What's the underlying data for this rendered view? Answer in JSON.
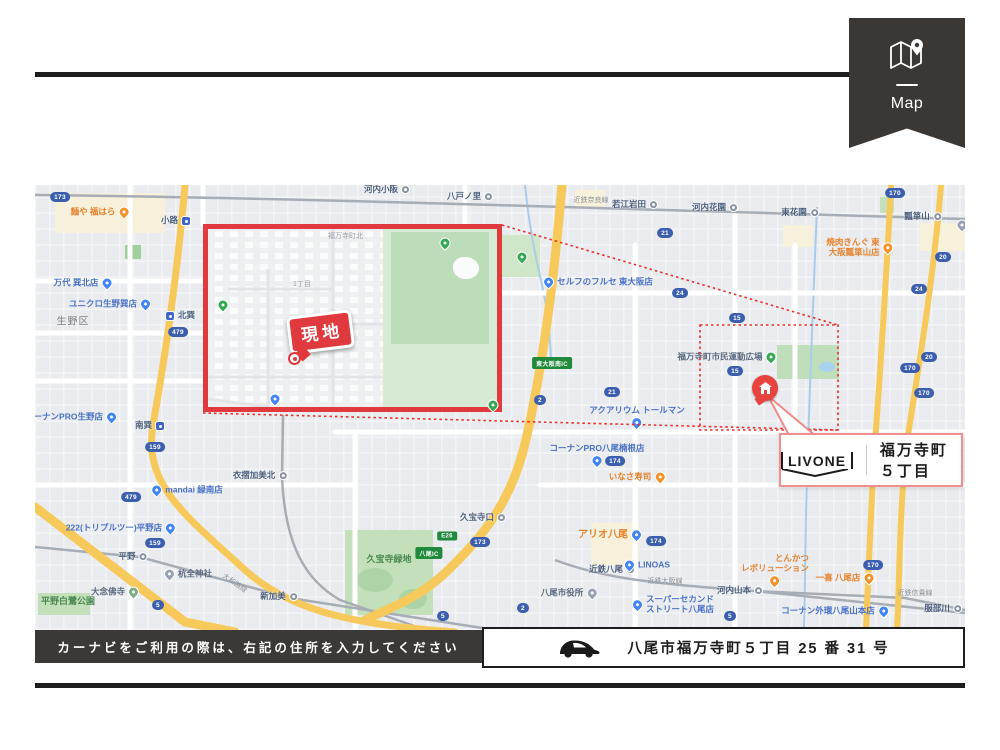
{
  "ribbon": {
    "label": "Map"
  },
  "inset": {
    "site_bubble": "現地",
    "area_label": "福万寺町北",
    "block_label": "1丁目"
  },
  "callout": {
    "brand": "LIVONE",
    "place": "福万寺町５丁目"
  },
  "footer": {
    "instruction": "カーナビをご利用の際は、右記の住所を入力してください",
    "address": "八尾市福万寺町５丁目 25 番 31 号"
  },
  "colors": {
    "accent_red": "#e0393e",
    "ribbon_bg": "#3a3734",
    "map_bg": "#e9ebee",
    "road_yellow": "#f6c95a",
    "park_green": "#c7e3c1",
    "badge_blue": "#3b5fae",
    "badge_green": "#1f8a3b",
    "shop_blue": "#4a72c8",
    "food_orange": "#e8822c"
  },
  "map": {
    "labels": [
      {
        "t": "小路",
        "x": 141,
        "y": 36,
        "k": "st-sub"
      },
      {
        "t": "北巽",
        "x": 145,
        "y": 131,
        "k": "st-sub",
        "s": "l"
      },
      {
        "t": "南巽",
        "x": 115,
        "y": 241,
        "k": "st-sub"
      },
      {
        "t": "河内小阪",
        "x": 352,
        "y": 5,
        "k": "st-rail"
      },
      {
        "t": "八戸ノ里",
        "x": 435,
        "y": 12,
        "k": "st-rail"
      },
      {
        "t": "若江岩田",
        "x": 600,
        "y": 20,
        "k": "st-rail"
      },
      {
        "t": "河内花園",
        "x": 680,
        "y": 23,
        "k": "st-rail"
      },
      {
        "t": "東花園",
        "x": 765,
        "y": 28,
        "k": "st-rail"
      },
      {
        "t": "瓢箪山",
        "x": 888,
        "y": 32,
        "k": "st-rail"
      },
      {
        "t": "久宝寺口",
        "x": 448,
        "y": 333,
        "k": "st-rail"
      },
      {
        "t": "近鉄八尾",
        "x": 577,
        "y": 385,
        "k": "st-rail"
      },
      {
        "t": "河内山本",
        "x": 705,
        "y": 406,
        "k": "st-rail"
      },
      {
        "t": "服部川",
        "x": 908,
        "y": 424,
        "k": "st-rail"
      },
      {
        "t": "平野",
        "x": 98,
        "y": 372,
        "k": "st-rail"
      },
      {
        "t": "新加美",
        "x": 244,
        "y": 412,
        "k": "st-rail"
      },
      {
        "t": "衣摺加美北",
        "x": 225,
        "y": 291,
        "k": "st-rail"
      },
      {
        "t": "万代 巽北店",
        "x": 48,
        "y": 98,
        "k": "shop"
      },
      {
        "t": "ユニクロ生野巽店",
        "x": 75,
        "y": 119,
        "k": "shop"
      },
      {
        "t": "コーナンPRO生野店",
        "x": 36,
        "y": 232,
        "k": "shop"
      },
      {
        "t": "mandai 緑南店",
        "x": 152,
        "y": 305,
        "k": "shop",
        "s": "l"
      },
      {
        "t": "222(トリプルツー)平野店",
        "x": 86,
        "y": 343,
        "k": "shop"
      },
      {
        "t": "セルフのフルセ 東大阪店",
        "x": 563,
        "y": 97,
        "k": "shop",
        "s": "l"
      },
      {
        "t": "アクアリウム トールマン",
        "x": 602,
        "y": 232,
        "k": "shop",
        "s": "b"
      },
      {
        "t": "コーナンPRO八尾楠根店",
        "x": 562,
        "y": 270,
        "k": "shop",
        "s": "b"
      },
      {
        "t": "LINOAS",
        "x": 612,
        "y": 380,
        "k": "shop",
        "s": "l"
      },
      {
        "t": "スーパーセカンド\nストリート八尾店",
        "x": 638,
        "y": 420,
        "k": "shop",
        "s": "l"
      },
      {
        "t": "コーナン外環八尾山本店",
        "x": 800,
        "y": 426,
        "k": "shop"
      },
      {
        "t": "アリオ八尾",
        "x": 575,
        "y": 350,
        "k": "mall"
      },
      {
        "t": "麺や 福はら",
        "x": 65,
        "y": 27,
        "k": "food"
      },
      {
        "t": "焼肉きんぐ 東\n大阪瓢箪山店",
        "x": 825,
        "y": 63,
        "k": "food"
      },
      {
        "t": "いなさ寿司",
        "x": 602,
        "y": 292,
        "k": "food"
      },
      {
        "t": "とんかつ\nレボリューション",
        "x": 740,
        "y": 385,
        "k": "food",
        "s": "b"
      },
      {
        "t": "一喜 八尾店",
        "x": 810,
        "y": 393,
        "k": "food"
      },
      {
        "t": "八尾市役所",
        "x": 534,
        "y": 408,
        "k": "govt"
      },
      {
        "t": "杭全神社",
        "x": 153,
        "y": 389,
        "k": "shrine",
        "s": "l"
      },
      {
        "t": "大念佛寺",
        "x": 80,
        "y": 407,
        "k": "temple"
      },
      {
        "t": "福万寺町市民運動広場",
        "x": 692,
        "y": 172,
        "k": "park-poi"
      },
      {
        "t": "生野区",
        "x": 38,
        "y": 137,
        "k": "district"
      },
      {
        "t": "久宝寺緑地",
        "x": 354,
        "y": 374,
        "k": "park"
      },
      {
        "t": "平野白鷺公園",
        "x": 33,
        "y": 416,
        "k": "park"
      },
      {
        "t": "近鉄奈良線",
        "x": 556,
        "y": 16,
        "k": "rail"
      },
      {
        "t": "近鉄大阪線",
        "x": 630,
        "y": 397,
        "k": "rail"
      },
      {
        "t": "近鉄信貴線",
        "x": 880,
        "y": 409,
        "k": "rail"
      },
      {
        "t": "大和路線",
        "x": 199,
        "y": 399,
        "k": "rail",
        "r": 35
      },
      {
        "t": "",
        "x": 487,
        "y": 72,
        "k": "pin"
      },
      {
        "t": "",
        "x": 927,
        "y": 40,
        "k": "pin-g"
      }
    ],
    "badges": [
      {
        "t": "173",
        "x": 25,
        "y": 12
      },
      {
        "t": "479",
        "x": 143,
        "y": 147
      },
      {
        "t": "479",
        "x": 96,
        "y": 312
      },
      {
        "t": "159",
        "x": 120,
        "y": 262
      },
      {
        "t": "159",
        "x": 120,
        "y": 358
      },
      {
        "t": "5",
        "x": 123,
        "y": 420
      },
      {
        "t": "2",
        "x": 505,
        "y": 215
      },
      {
        "t": "21",
        "x": 577,
        "y": 207
      },
      {
        "t": "21",
        "x": 630,
        "y": 48
      },
      {
        "t": "24",
        "x": 645,
        "y": 108
      },
      {
        "t": "24",
        "x": 884,
        "y": 104
      },
      {
        "t": "174",
        "x": 580,
        "y": 276
      },
      {
        "t": "174",
        "x": 621,
        "y": 356
      },
      {
        "t": "15",
        "x": 702,
        "y": 133
      },
      {
        "t": "15",
        "x": 700,
        "y": 186
      },
      {
        "t": "170",
        "x": 860,
        "y": 8
      },
      {
        "t": "170",
        "x": 875,
        "y": 183
      },
      {
        "t": "170",
        "x": 889,
        "y": 208
      },
      {
        "t": "170",
        "x": 838,
        "y": 380
      },
      {
        "t": "20",
        "x": 908,
        "y": 72
      },
      {
        "t": "20",
        "x": 894,
        "y": 172
      },
      {
        "t": "173",
        "x": 445,
        "y": 357
      },
      {
        "t": "2",
        "x": 488,
        "y": 423
      },
      {
        "t": "5",
        "x": 408,
        "y": 431
      },
      {
        "t": "5",
        "x": 695,
        "y": 431
      },
      {
        "t": "東大阪南IC",
        "x": 517,
        "y": 178,
        "v": "g"
      },
      {
        "t": "E26",
        "x": 412,
        "y": 351,
        "v": "g"
      },
      {
        "t": "八尾IC",
        "x": 394,
        "y": 368,
        "v": "g"
      }
    ],
    "inset_pins": [
      {
        "x": 15,
        "y": 76,
        "k": "pin"
      },
      {
        "x": 237,
        "y": 14,
        "k": "pin"
      },
      {
        "x": 285,
        "y": 176,
        "k": "pin"
      },
      {
        "x": 67,
        "y": 170,
        "k": "pin-b"
      }
    ]
  }
}
